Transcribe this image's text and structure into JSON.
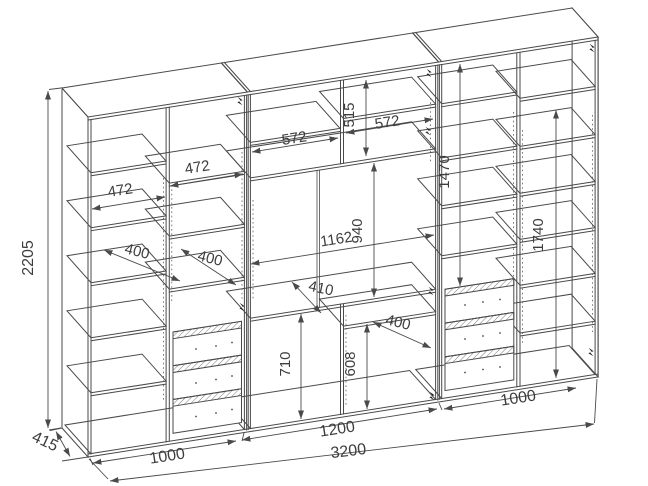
{
  "drawing": {
    "type": "furniture technical dimension drawing",
    "subject": "three-section wall unit / wardrobe with shelves, TV niche and drawers",
    "line_color": "#4a4a4a",
    "text_color": "#3d3d3d",
    "background_color": "#ffffff"
  },
  "dims": {
    "overall_height": "2205",
    "overall_depth": "415",
    "overall_width": "3200",
    "section_left_width": "1000",
    "section_middle_width": "1200",
    "section_right_width": "1000",
    "left_col1_width": "472",
    "left_col2_width": "472",
    "left_col1_shelf_depth": "400",
    "left_col2_shelf_depth": "400",
    "mid_cubby_left_width": "572",
    "mid_cubby_right_width": "572",
    "mid_cubby_height": "515",
    "niche_width": "1162",
    "niche_height": "940",
    "niche_shelf_depth": "410",
    "mid_lower_left_height": "710",
    "mid_lower_right_height": "608",
    "mid_lower_shelf_depth": "400",
    "right_col1_height": "1470",
    "right_col2_height": "1740"
  }
}
